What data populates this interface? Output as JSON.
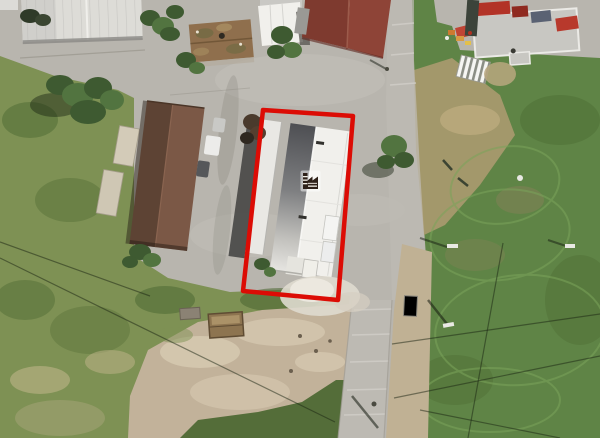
{
  "image": {
    "type": "aerial-photograph",
    "width_px": 600,
    "height_px": 438,
    "description": "Aerial view of an industrial yard: a long white-roofed warehouse outlined in red with a factory icon, a brown-roofed building beside it, white and maroon roofs at top, roads, dirt lot and green fields"
  },
  "annotation": {
    "outline_points": "263,110 353,116 338,300 243,291",
    "outline_color": "#dc0c05",
    "outline_stroke_width": "4.5",
    "icon": "factory-icon",
    "icon_transform": "translate(302,172)"
  },
  "colors": {
    "pavement": "#b8b5ae",
    "pavementLight": "#c8c5be",
    "road": "#bdbab3",
    "grass1": "#7e9154",
    "grass2": "#5f8446",
    "grass3": "#48652f",
    "grass4": "#7ba45a",
    "dried": "#ab9a6f",
    "dirt": "#c2b29a",
    "dirtLight": "#d7cab2",
    "tan": "#c0b194",
    "rust": "#8f6f4d",
    "maroon1": "#7e3a2f",
    "maroon2": "#8e4437",
    "brown1": "#5d4334",
    "brown2": "#7b5846",
    "whiteroof": "#dddcd7",
    "whiteroofBright": "#f1f0ec",
    "slopeDark": "#55565a",
    "tree1": "#3e5a31",
    "tree2": "#527440",
    "treeShadow": "rgba(25,35,18,0.45)",
    "wire": "rgba(25,35,18,0.5)"
  }
}
